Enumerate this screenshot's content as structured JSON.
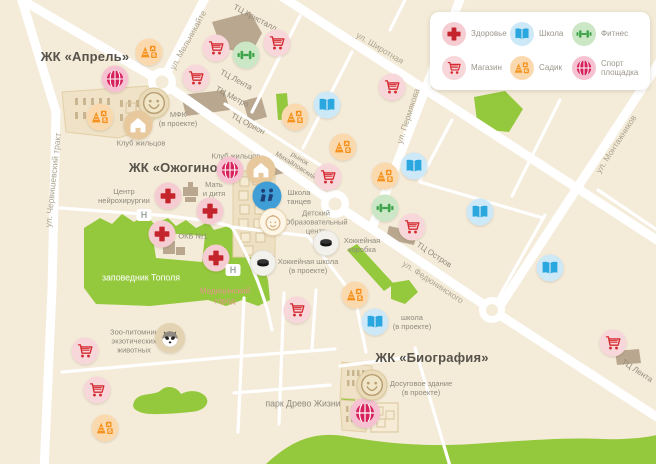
{
  "colors": {
    "map_bg": "#f4ebd9",
    "road": "#ffffff",
    "park_green": "#95c93d",
    "health_red": "#c4242b",
    "shop_red": "#d42a30",
    "school_blue": "#2ba7e0",
    "fitness_green": "#3ea44a",
    "kindergarten_orange": "#f6921e",
    "sport_crimson": "#d6215c"
  },
  "legend": {
    "items": [
      {
        "type": "health",
        "label": "Здоровье"
      },
      {
        "type": "book",
        "label": "Школа"
      },
      {
        "type": "fitness",
        "label": "Фитнес"
      },
      {
        "type": "cart",
        "label": "Магазин"
      },
      {
        "type": "kindergarten",
        "label": "Садик"
      },
      {
        "type": "sport",
        "label": "Спорт площадка"
      }
    ]
  },
  "map": {
    "labels": [
      {
        "id": "zk-aprel",
        "text": "ЖК «Апрель»",
        "x": 85,
        "y": 57,
        "kind": "title"
      },
      {
        "id": "zk-ozhogino",
        "text": "ЖК «Ожогино»",
        "x": 177,
        "y": 168,
        "kind": "title"
      },
      {
        "id": "zk-biografiya",
        "text": "ЖК «Биография»",
        "x": 432,
        "y": 358,
        "kind": "title"
      },
      {
        "id": "mfk",
        "text": "МФК\n(в проекте)",
        "x": 178,
        "y": 119,
        "kind": "place"
      },
      {
        "id": "klub-zhiltsov-1",
        "text": "Клуб жильцов",
        "x": 141,
        "y": 143,
        "kind": "place"
      },
      {
        "id": "klub-zhiltsov-2",
        "text": "Клуб жильцов",
        "x": 236,
        "y": 156,
        "kind": "place"
      },
      {
        "id": "shkola-tantsev",
        "text": "Школа\nтанцев",
        "x": 299,
        "y": 197,
        "kind": "place"
      },
      {
        "id": "detsky-centr",
        "text": "Детский\nОбразовательный\nцентр",
        "x": 316,
        "y": 222,
        "kind": "place"
      },
      {
        "id": "hokkeynaya-korobka",
        "text": "Хоккейная\nкоробка",
        "x": 362,
        "y": 245,
        "kind": "place"
      },
      {
        "id": "hokkeynaya-shkola",
        "text": "Хоккейная школа\n(в проекте)",
        "x": 308,
        "y": 266,
        "kind": "place"
      },
      {
        "id": "centr-neyrohirurgii",
        "text": "Центр\nнейрохирургии",
        "x": 124,
        "y": 196,
        "kind": "place"
      },
      {
        "id": "mat-i-ditya",
        "text": "Мать\nи дитя",
        "x": 214,
        "y": 189,
        "kind": "place"
      },
      {
        "id": "okb",
        "text": "ОКБ №1",
        "x": 193,
        "y": 236,
        "kind": "place"
      },
      {
        "id": "shkola-v-proekte",
        "text": "школа\n(в проекте)",
        "x": 412,
        "y": 322,
        "kind": "place"
      },
      {
        "id": "dosugovoe-zdanie",
        "text": "Досуговое здание\n(в проекте)",
        "x": 421,
        "y": 388,
        "kind": "place"
      },
      {
        "id": "zoo-pitomnik",
        "text": "Зоо-питомник\nэкзотических\nживотных",
        "x": 134,
        "y": 341,
        "kind": "place"
      },
      {
        "id": "zapovednik-topolya",
        "text": "заповедник Тополя",
        "x": 141,
        "y": 278,
        "kind": "park-white"
      },
      {
        "id": "park-drevo-zhizni",
        "text": "парк Древо Жизни",
        "x": 303,
        "y": 404,
        "kind": "park-gray"
      },
      {
        "id": "medicinsky-gorod",
        "text": "Медицинский\nгород",
        "x": 225,
        "y": 296,
        "kind": "med"
      },
      {
        "id": "ul-melnikaite",
        "text": "ул. Мельникайте",
        "x": 188,
        "y": 40,
        "rot": -61,
        "kind": "street"
      },
      {
        "id": "ul-shirotnaya",
        "text": "ул. Широтная",
        "x": 380,
        "y": 48,
        "rot": 31,
        "kind": "street"
      },
      {
        "id": "ul-permyakova",
        "text": "ул. Пермякова",
        "x": 408,
        "y": 116,
        "rot": -72,
        "kind": "street"
      },
      {
        "id": "ul-montazhnikov",
        "text": "ул. Монтажников",
        "x": 616,
        "y": 144,
        "rot": -57,
        "kind": "street"
      },
      {
        "id": "ul-fedyuninskogo",
        "text": "ул. Федюнинского",
        "x": 433,
        "y": 282,
        "rot": 33,
        "kind": "street"
      },
      {
        "id": "ul-chervishevsky-trakt",
        "text": "ул. Червишевский тракт",
        "x": 53,
        "y": 180,
        "rot": -84,
        "kind": "street"
      },
      {
        "id": "tc-kristall",
        "text": "ТЦ Кристалл",
        "x": 255,
        "y": 18,
        "rot": 28,
        "kind": "mall"
      },
      {
        "id": "tc-lenta-1",
        "text": "ТЦ Лента",
        "x": 236,
        "y": 80,
        "rot": 28,
        "kind": "mall"
      },
      {
        "id": "tc-metro",
        "text": "ТЦ Метро",
        "x": 232,
        "y": 97,
        "rot": 28,
        "kind": "mall"
      },
      {
        "id": "tc-orion",
        "text": "ТЦ Орион",
        "x": 248,
        "y": 124,
        "rot": 28,
        "kind": "mall"
      },
      {
        "id": "rynok-mihaylovsky",
        "text": "рынок\nМихайловский",
        "x": 297,
        "y": 163,
        "rot": 32,
        "kind": "mall-sm"
      },
      {
        "id": "tc-ostrov",
        "text": "ТЦ Остров",
        "x": 434,
        "y": 255,
        "rot": 33,
        "kind": "mall"
      },
      {
        "id": "tc-lenta-2",
        "text": "ТЦ Лента",
        "x": 637,
        "y": 371,
        "rot": 33,
        "kind": "mall"
      }
    ],
    "markers": [
      {
        "type": "health",
        "x": 168,
        "y": 196
      },
      {
        "type": "health",
        "x": 210,
        "y": 211
      },
      {
        "type": "health",
        "x": 162,
        "y": 234
      },
      {
        "type": "health",
        "x": 216,
        "y": 258
      },
      {
        "type": "cart",
        "x": 216,
        "y": 48
      },
      {
        "type": "cart",
        "x": 277,
        "y": 43
      },
      {
        "type": "cart",
        "x": 196,
        "y": 78
      },
      {
        "type": "cart",
        "x": 392,
        "y": 87
      },
      {
        "type": "cart",
        "x": 328,
        "y": 177
      },
      {
        "type": "cart",
        "x": 412,
        "y": 227
      },
      {
        "type": "cart",
        "x": 297,
        "y": 310
      },
      {
        "type": "cart",
        "x": 85,
        "y": 351
      },
      {
        "type": "cart",
        "x": 97,
        "y": 390
      },
      {
        "type": "cart",
        "x": 613,
        "y": 343
      },
      {
        "type": "book",
        "x": 327,
        "y": 105
      },
      {
        "type": "book",
        "x": 414,
        "y": 166
      },
      {
        "type": "book",
        "x": 480,
        "y": 212
      },
      {
        "type": "book",
        "x": 550,
        "y": 268
      },
      {
        "type": "book",
        "x": 375,
        "y": 322
      },
      {
        "type": "fitness",
        "x": 246,
        "y": 55
      },
      {
        "type": "fitness",
        "x": 385,
        "y": 208
      },
      {
        "type": "kindergarten",
        "x": 149,
        "y": 52
      },
      {
        "type": "kindergarten",
        "x": 100,
        "y": 117
      },
      {
        "type": "kindergarten",
        "x": 295,
        "y": 117
      },
      {
        "type": "kindergarten",
        "x": 343,
        "y": 147
      },
      {
        "type": "kindergarten",
        "x": 385,
        "y": 176
      },
      {
        "type": "kindergarten",
        "x": 355,
        "y": 295
      },
      {
        "type": "kindergarten",
        "x": 105,
        "y": 428
      },
      {
        "type": "sport",
        "x": 115,
        "y": 79
      },
      {
        "type": "sport",
        "x": 230,
        "y": 170
      },
      {
        "type": "sport",
        "x": 365,
        "y": 413,
        "s": 30
      },
      {
        "type": "smiley",
        "x": 154,
        "y": 103,
        "s": 31
      },
      {
        "type": "smiley",
        "x": 372,
        "y": 385,
        "s": 31
      },
      {
        "type": "house",
        "x": 138,
        "y": 125,
        "s": 29
      },
      {
        "type": "house",
        "x": 261,
        "y": 170,
        "s": 29
      },
      {
        "type": "dancers",
        "x": 267,
        "y": 196,
        "s": 29
      },
      {
        "type": "baby",
        "x": 273,
        "y": 222,
        "s": 28
      },
      {
        "type": "puck",
        "x": 326,
        "y": 243,
        "s": 26
      },
      {
        "type": "puck",
        "x": 263,
        "y": 263,
        "s": 26
      },
      {
        "type": "raccoon",
        "x": 170,
        "y": 338,
        "s": 30
      },
      {
        "type": "helipad",
        "x": 144,
        "y": 215
      },
      {
        "type": "helipad",
        "x": 233,
        "y": 270
      }
    ]
  }
}
